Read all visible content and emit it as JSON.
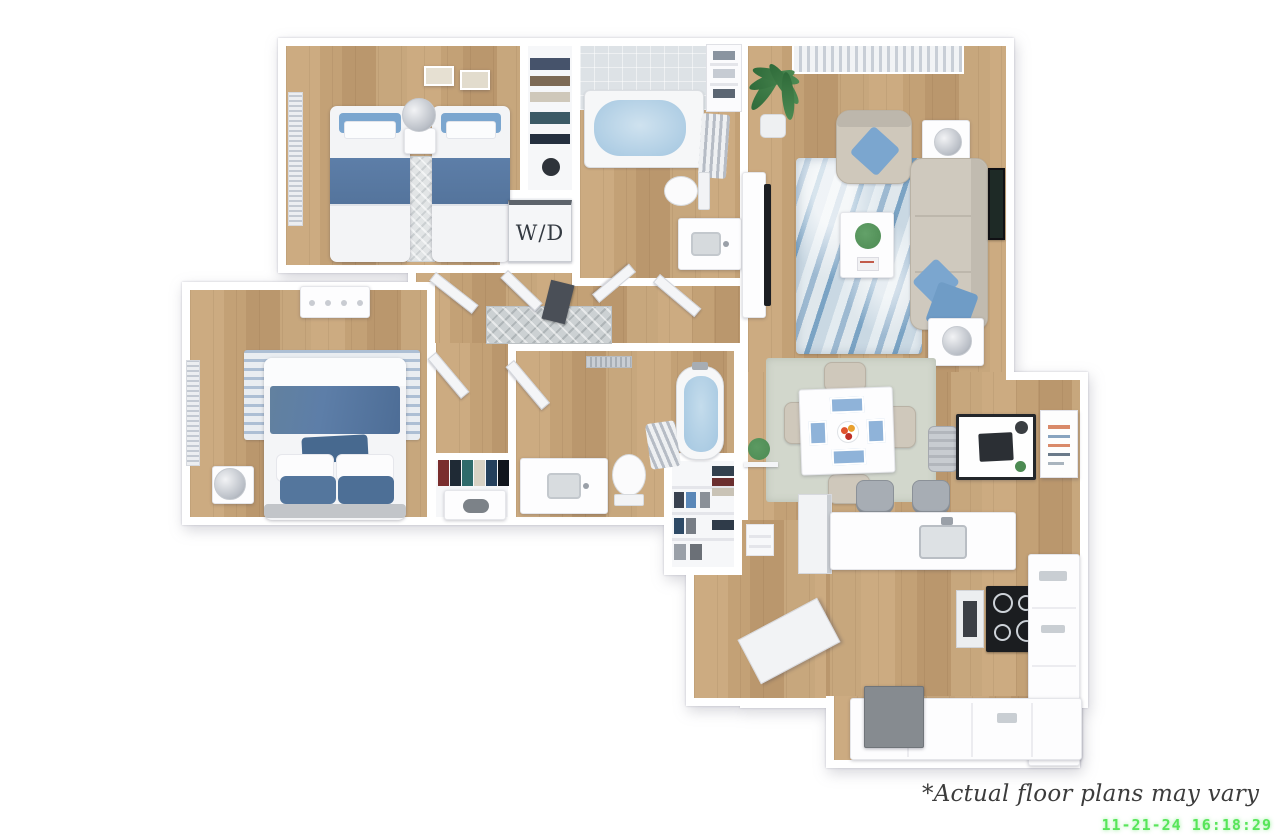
{
  "labels": {
    "washer_dryer": "W/D"
  },
  "footer": {
    "disclaimer": "*Actual floor plans may vary",
    "timestamp": "11-21-24 16:18:29"
  },
  "colors": {
    "wall": "#ffffff",
    "floor_wood": "#c3a075",
    "accent_blue": "#5d7ea8",
    "pillow_blue": "#7ba6cf",
    "rug_living_blue": "#9db9d1",
    "rug_dining_sage": "#d2d7cc",
    "tub_water_blue": "#a3c6e0",
    "sofa_beige": "#cfc9be",
    "appliance_black": "#1b1d20",
    "plant_green": "#4c8a52",
    "timestamp_green": "#58e55a",
    "caption_gray": "#3c3c3c"
  }
}
